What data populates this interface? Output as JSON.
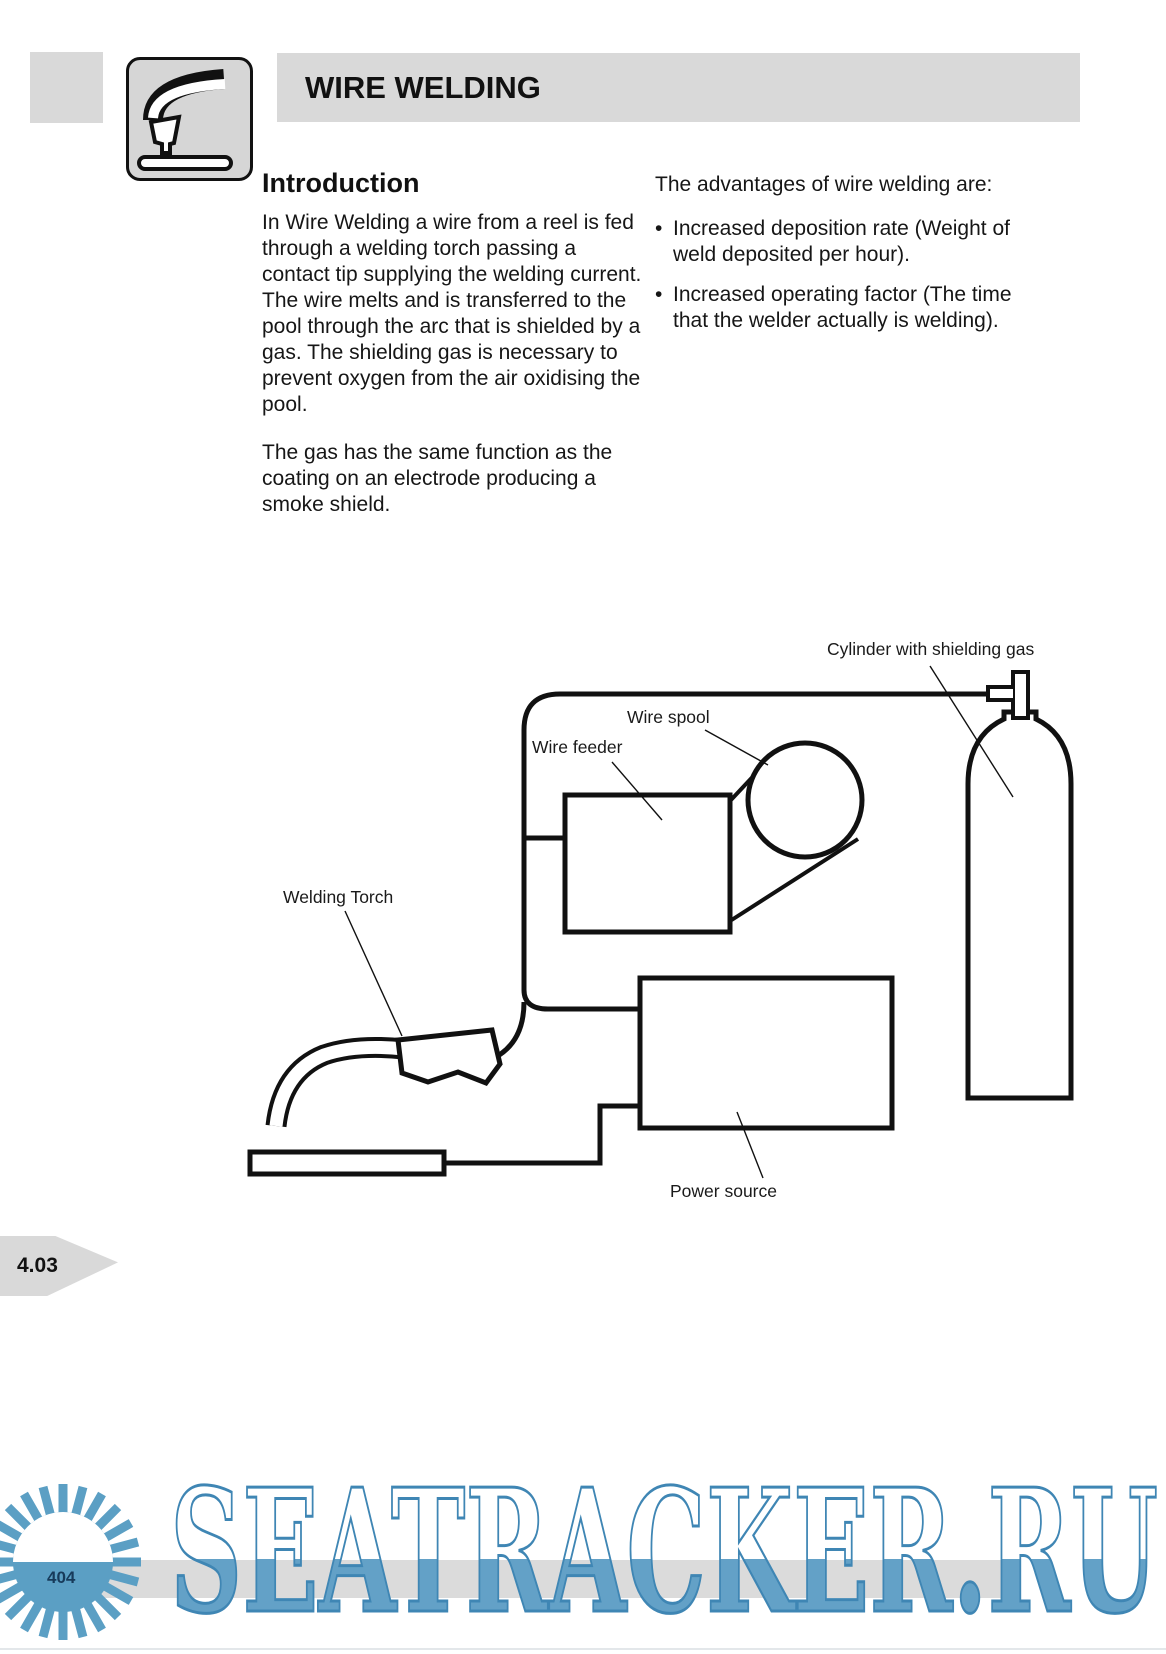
{
  "header": {
    "title": "WIRE WELDING"
  },
  "icon": {
    "name": "welding-torch-icon"
  },
  "intro": {
    "heading": "Introduction",
    "para1": "In Wire Welding a wire from a reel is fed through a welding torch  passing a contact tip  supplying  the welding current. The wire melts  and is transferred to the pool through the arc that is shielded by a gas. The shielding gas is necessary  to prevent oxygen from the air oxidising the pool.",
    "para2": "The gas has the same function as the coating on an electrode producing a smoke shield."
  },
  "advantages": {
    "lead": "The advantages of wire welding are:",
    "bullet": "•",
    "items": [
      {
        "text": "Increased deposition rate (Weight of weld deposited per hour)."
      },
      {
        "text": "Increased operating factor (The time that the welder actually is welding)."
      }
    ]
  },
  "diagram": {
    "labels": {
      "cylinder": "Cylinder with shielding gas",
      "spool": "Wire spool",
      "feeder": "Wire feeder",
      "torch": "Welding Torch",
      "power": "Power source"
    }
  },
  "footer": {
    "section": "4.03",
    "page": "404"
  },
  "watermark": {
    "text": "SEATRACKER.RU",
    "accent_blue": "#4d92bd",
    "bar_gray": "#d9d9d9"
  }
}
